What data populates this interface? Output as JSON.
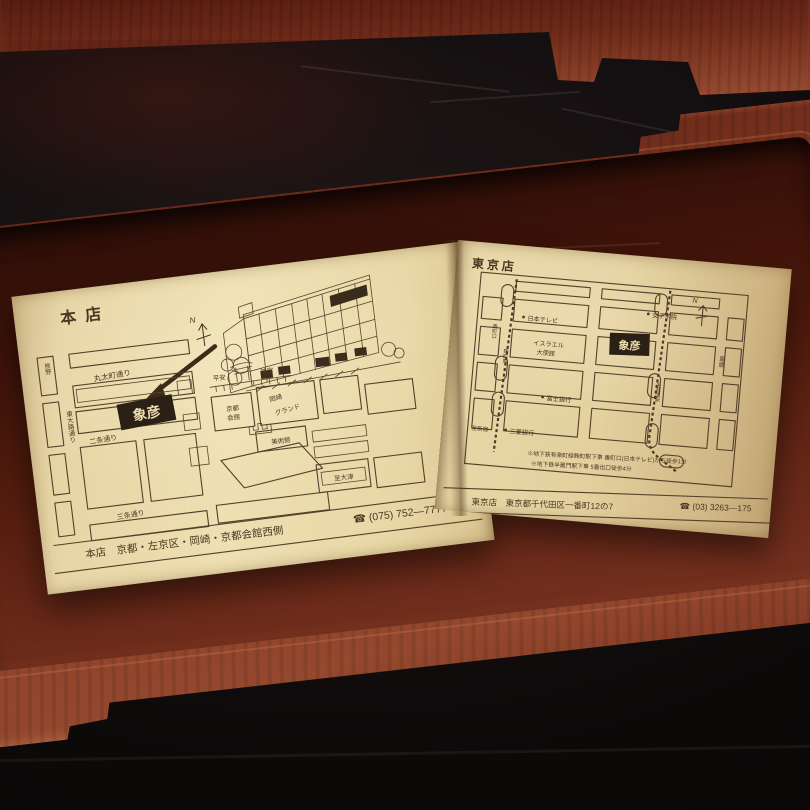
{
  "scene": {
    "kyoto_page": {
      "title": "本店",
      "compass": "N",
      "marker": "象彦",
      "street_marutamachi": "丸太町通り",
      "street_higashioji": "東大路通り",
      "street_nijo": "二条通り",
      "street_sanjo": "三条通り",
      "area_kumano": "熊野",
      "heian_1": "平安",
      "heian_2": "神宮",
      "kaikan_1": "京都",
      "kaikan_2": "会館",
      "okazaki_1": "岡崎",
      "okazaki_2": "グランド",
      "museum": "美術館",
      "to_otsu": "至大津",
      "footer_address": "本店　京都・左京区・岡崎・京都会館西側",
      "footer_phone": "☎ (075) 752—7777"
    },
    "tokyo_page": {
      "title": "東京店",
      "compass": "N",
      "marker": "象彦",
      "nihon_tv": "日本テレビ",
      "joshi_gakuin": "女子学院",
      "israel_1": "イスラエル",
      "israel_2": "大使館",
      "fuji_bank": "富士銀行",
      "mitsubishi_bank": "三菱銀行",
      "bancho_guchi": "番町口",
      "kojimachi_sta": "麹町駅",
      "hanzomon_sta": "半蔵門駅",
      "to_shinjuku": "至新宿",
      "kokyo": "皇居",
      "note_1": "※地下鉄有楽町線麹町駅下車 番町口(日本テレビ)から徒歩1分",
      "note_2": "※地下鉄半蔵門駅下車 5番出口徒歩4分",
      "footer_address": "東京店　東京都千代田区一番町12の7",
      "footer_phone": "☎ (03) 3263—175"
    }
  }
}
